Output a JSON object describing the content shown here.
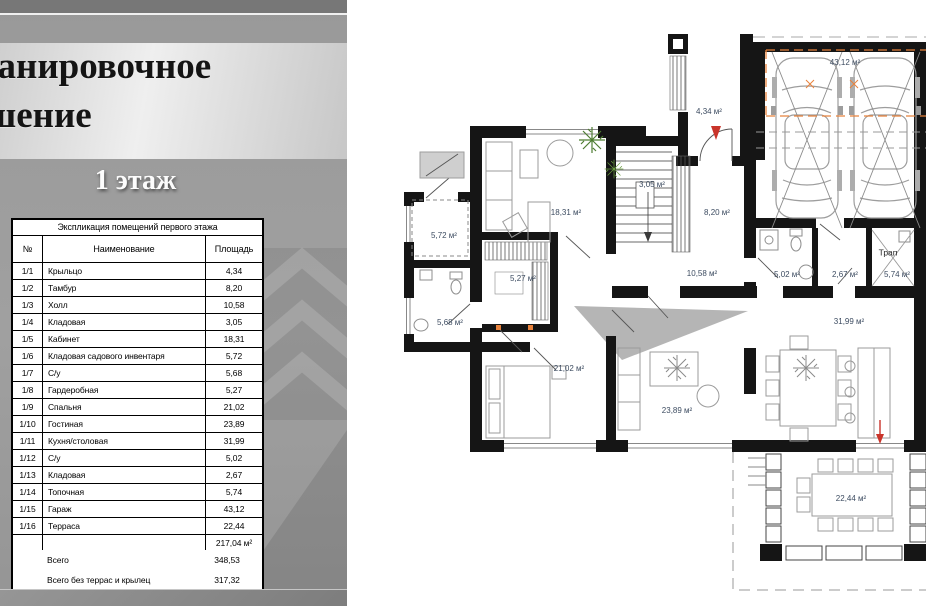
{
  "panel": {
    "title_line1": "Планировочное",
    "title_line2": "решение",
    "floor_heading": "1 этаж",
    "table": {
      "caption": "Экспликация помещений первого этажа",
      "col_num": "№",
      "col_name": "Наименование",
      "col_area": "Площадь",
      "rows": [
        {
          "num": "1/1",
          "name": "Крыльцо",
          "area": "4,34"
        },
        {
          "num": "1/2",
          "name": "Тамбур",
          "area": "8,20"
        },
        {
          "num": "1/3",
          "name": "Холл",
          "area": "10,58"
        },
        {
          "num": "1/4",
          "name": "Кладовая",
          "area": "3,05"
        },
        {
          "num": "1/5",
          "name": "Кабинет",
          "area": "18,31"
        },
        {
          "num": "1/6",
          "name": "Кладовая садового инвентаря",
          "area": "5,72"
        },
        {
          "num": "1/7",
          "name": "С/у",
          "area": "5,68"
        },
        {
          "num": "1/8",
          "name": "Гардеробная",
          "area": "5,27"
        },
        {
          "num": "1/9",
          "name": "Спальня",
          "area": "21,02"
        },
        {
          "num": "1/10",
          "name": "Гостиная",
          "area": "23,89"
        },
        {
          "num": "1/11",
          "name": "Кухня/столовая",
          "area": "31,99"
        },
        {
          "num": "1/12",
          "name": "С/у",
          "area": "5,02"
        },
        {
          "num": "1/13",
          "name": "Кладовая",
          "area": "2,67"
        },
        {
          "num": "1/14",
          "name": "Топочная",
          "area": "5,74"
        },
        {
          "num": "1/15",
          "name": "Гараж",
          "area": "43,12"
        },
        {
          "num": "1/16",
          "name": "Терраса",
          "area": "22,44"
        }
      ],
      "subtotal": "217,04 м²",
      "totals": [
        {
          "label": "Всего",
          "value": "348,53"
        },
        {
          "label": "Всего без террас и крылец",
          "value": "317,32"
        }
      ]
    }
  },
  "plan": {
    "labels": {
      "garage": "43,12 м²",
      "porch": "4,34 м²",
      "garden_storage": "5,72 м²",
      "cabinet": "18,31 м²",
      "understairs": "3,05 м²",
      "tambour": "8,20 м²",
      "hall": "10,58 м²",
      "wardrobe": "5,27 м²",
      "bath1": "5,68 м²",
      "bath2": "5,02 м²",
      "storage2": "2,67 м²",
      "boiler": "5,74 м²",
      "trap": "Трап",
      "bedroom": "21,02 м²",
      "living": "23,89 м²",
      "kitchen": "31,99 м²",
      "terrace": "22,44 м²"
    }
  },
  "colors": {
    "wall_black": "#151515",
    "accent_orange": "#e8823c",
    "accent_red": "#c9342a",
    "plant_green": "#4e7d32",
    "label_color": "#3d4c61",
    "panel_gray": "#9b9b9b"
  }
}
